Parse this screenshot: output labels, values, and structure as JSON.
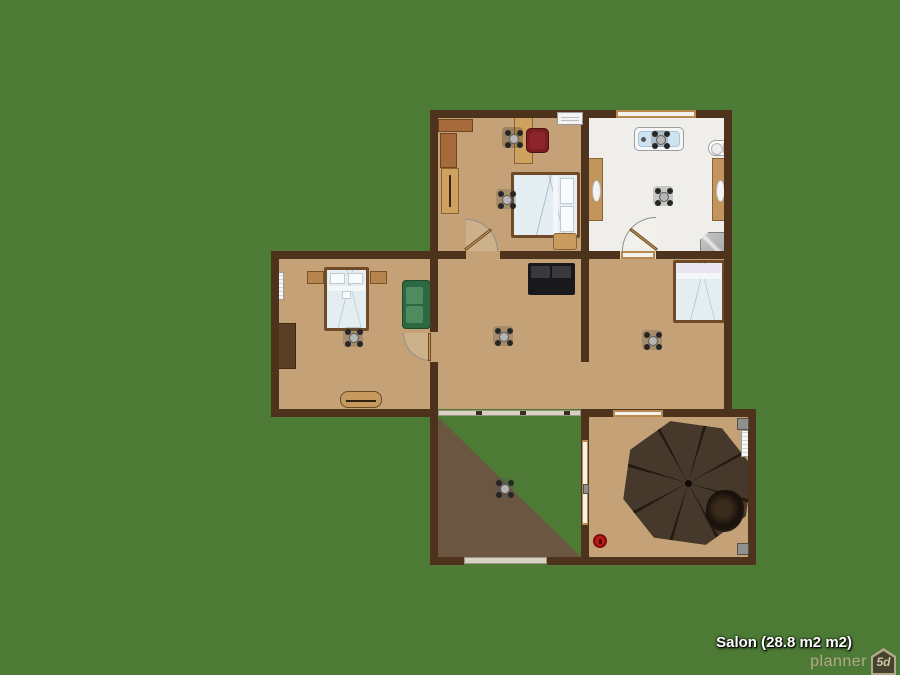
{
  "watermark": {
    "room_label": "Salon (28.8 m2 m2)",
    "brand": "planner",
    "brand_badge": "5d"
  },
  "colors": {
    "background": "#4d7a35",
    "wall": "#4e331c",
    "floor": "#c4a176",
    "bathroom_floor": "#efeeea",
    "terrace_shadow": "#6b5741",
    "glass_wall": "#d8d2c3",
    "bed_linen": "#e3edf2",
    "green_sofa": "#2c6841",
    "black_sofa": "#19181d",
    "umbrella": "#46392c",
    "accent_red": "#c01717",
    "label_text": "#ffffff",
    "brand_text": "#b3a98c"
  },
  "rooms": [
    {
      "name": "bedroom-top-left",
      "furniture": [
        "corner-shelf",
        "wardrobe",
        "tall-cabinet",
        "desk",
        "office-chair",
        "red-armchair",
        "double-bed",
        "foot-chest",
        "ceiling-fan",
        "curtain-rail",
        "ac-unit"
      ]
    },
    {
      "name": "bathroom",
      "furniture": [
        "bathtub",
        "toilet",
        "mirror-cabinet-left",
        "mirror-cabinet-right",
        "shower",
        "ceiling-fan",
        "ceiling-fan-over-tub",
        "window"
      ]
    },
    {
      "name": "bedroom-mid-left",
      "furniture": [
        "double-bed",
        "nightstand-left",
        "nightstand-right",
        "green-sofa",
        "dresser",
        "bench",
        "radiator",
        "ceiling-fan"
      ]
    },
    {
      "name": "salon",
      "furniture": [
        "black-sofa",
        "ceiling-fan"
      ]
    },
    {
      "name": "bedroom-mid-right",
      "furniture": [
        "single-bed",
        "ceiling-fan",
        "window"
      ]
    },
    {
      "name": "terrace",
      "furniture": [
        "ceiling-fan"
      ]
    },
    {
      "name": "patio",
      "furniture": [
        "parasol-table",
        "chair-left",
        "chair-right",
        "chair-bottom",
        "hanging-chair",
        "fire-hydrant",
        "radiator",
        "corner-tiles"
      ]
    }
  ]
}
